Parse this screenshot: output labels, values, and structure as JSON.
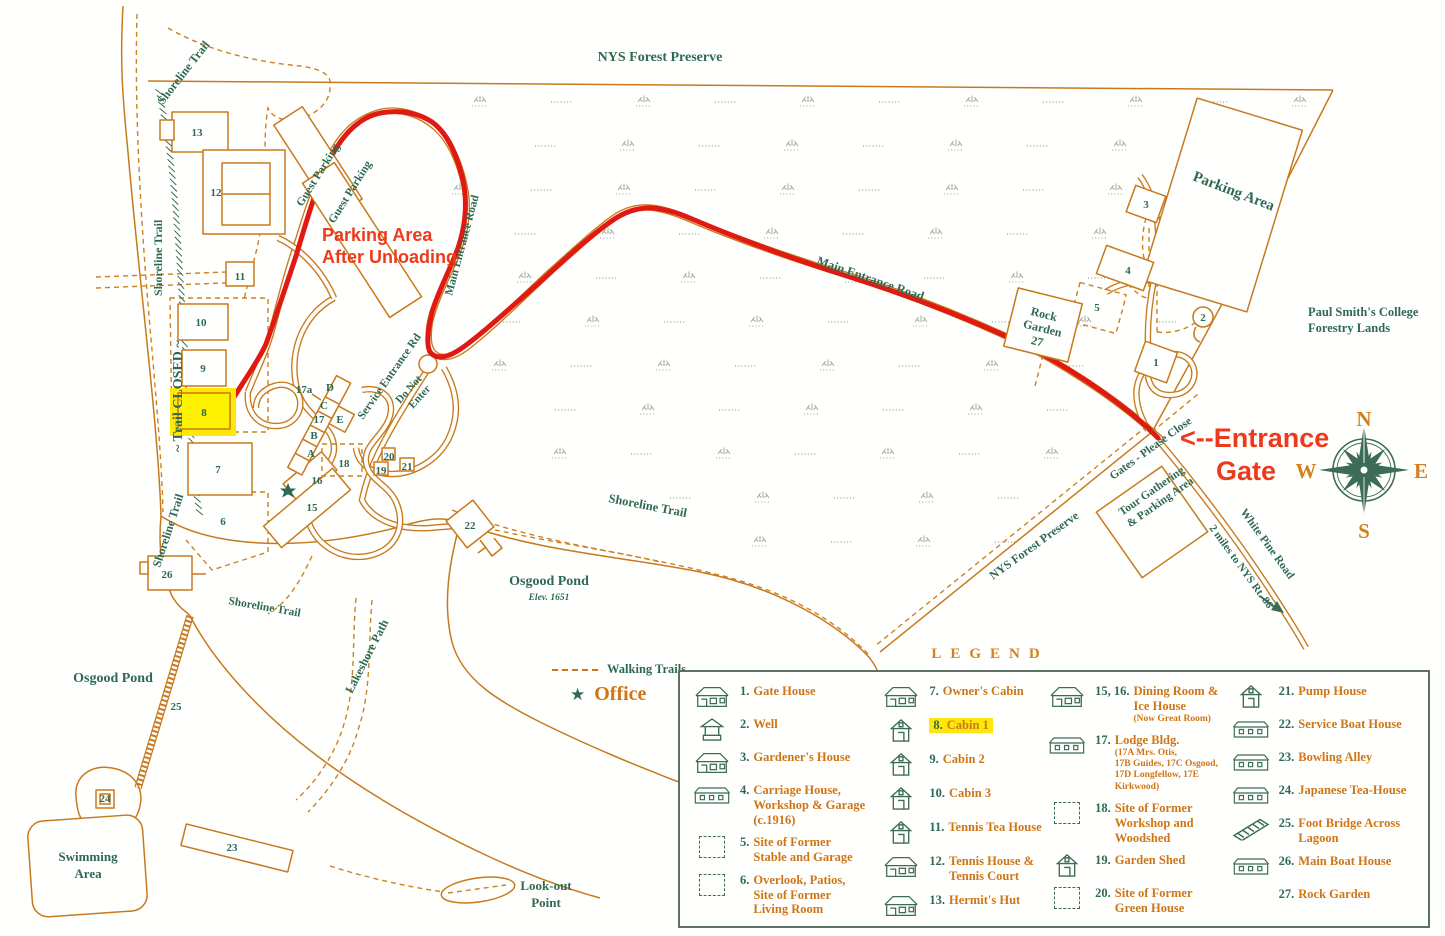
{
  "colors": {
    "map_line_orange": "#c8791b",
    "label_green": "#2f6953",
    "route_red": "#e01a12",
    "annotation_red": "#ee3a1c",
    "highlight_yellow": "#ffe70a"
  },
  "map": {
    "labels": {
      "nys_forest_preserve_top": "NYS Forest Preserve",
      "nys_forest_preserve_diag": "NYS Forest Preserve",
      "shoreline_trail_nw": "Shoreline Trail",
      "shoreline_trail_west": "Shoreline Trail",
      "trail_closed": "~ Trail CLOSED ~",
      "shoreline_trail_sw": "Shoreline Trail",
      "shoreline_trail_mid": "Shoreline Trail",
      "shoreline_trail_low": "Shoreline Trail",
      "guest_parking_1": "Guest Parking",
      "guest_parking_2": "Guest Parking",
      "main_entrance_road_vertical": "Main Entrance Road",
      "main_entrance_road_diagonal": "Main Entrance Road",
      "service_entrance_rd": "Service Entrance Rd",
      "do_not_enter_1": "Do Not",
      "do_not_enter_2": "Enter",
      "parking_area": "Parking Area",
      "rock_garden_1": "Rock",
      "rock_garden_2": "Garden",
      "rock_garden_3": "27",
      "paul_smiths_1": "Paul Smith's College",
      "paul_smiths_2": "Forestry Lands",
      "gates_please_close": "Gates - Please Close",
      "tour_gathering_1": "Tour Gathering",
      "tour_gathering_2": "& Parking Area",
      "white_pine_road": "White Pine Road",
      "miles_to_rt86": "2 miles to NYS Rt. 86",
      "osgood_pond_center": "Osgood Pond",
      "osgood_pond_elev": "Elev. 1651",
      "osgood_pond_west": "Osgood Pond",
      "lakeshore_path": "Lakeshore Path",
      "swimming_area_1": "Swimming",
      "swimming_area_2": "Area",
      "lookout_1": "Look-out",
      "lookout_2": "Point"
    },
    "annotations": {
      "parking_note_1": "Parking Area",
      "parking_note_2": "After Unloading",
      "entrance_gate_1": "<--Entrance",
      "entrance_gate_2": "Gate"
    },
    "compass": {
      "n": "N",
      "e": "E",
      "s": "S",
      "w": "W"
    },
    "numbers": {
      "n1": "1",
      "n2": "2",
      "n3": "3",
      "n4": "4",
      "n5": "5",
      "n6": "6",
      "n7": "7",
      "n8": "8",
      "n9": "9",
      "n10": "10",
      "n11": "11",
      "n12": "12",
      "n13": "13",
      "n15": "15",
      "n16": "16",
      "n17": "17",
      "n17a": "17a",
      "n18": "18",
      "n19": "19",
      "n20": "20",
      "n21": "21",
      "n22": "22",
      "n23": "23",
      "n24": "24",
      "n25": "25",
      "n26": "26"
    },
    "lodge_letters": {
      "a": "A",
      "b": "B",
      "c": "C",
      "d": "D",
      "e": "E"
    }
  },
  "map_key": {
    "walking_trails": "Walking Trails",
    "office": "Office"
  },
  "legend": {
    "title": "LEGEND",
    "items": [
      {
        "num": "1.",
        "label": "Gate House"
      },
      {
        "num": "2.",
        "label": "Well"
      },
      {
        "num": "3.",
        "label": "Gardener's House"
      },
      {
        "num": "4.",
        "label": "Carriage House,\nWorkshop & Garage\n(c.1916)"
      },
      {
        "num": "5.",
        "label": "Site of Former\nStable and Garage"
      },
      {
        "num": "6.",
        "label": "Overlook, Patios,\nSite of Former\nLiving Room"
      },
      {
        "num": "7.",
        "label": "Owner's Cabin"
      },
      {
        "num": "8.",
        "label": "Cabin 1"
      },
      {
        "num": "9.",
        "label": "Cabin 2"
      },
      {
        "num": "10.",
        "label": "Cabin 3"
      },
      {
        "num": "11.",
        "label": "Tennis Tea House"
      },
      {
        "num": "12.",
        "label": "Tennis House &\nTennis Court"
      },
      {
        "num": "13.",
        "label": "Hermit's Hut"
      },
      {
        "num": "15, 16.",
        "label": "Dining Room &\nIce House",
        "sub": "(Now Great Room)"
      },
      {
        "num": "17.",
        "label": "Lodge Bldg.",
        "sub": "(17A Mrs. Otis,\n17B Guides, 17C Osgood,\n17D Longfellow, 17E Kirkwood)"
      },
      {
        "num": "18.",
        "label": "Site of Former\nWorkshop and\nWoodshed"
      },
      {
        "num": "19.",
        "label": "Garden Shed"
      },
      {
        "num": "20.",
        "label": "Site of Former\nGreen House"
      },
      {
        "num": "21.",
        "label": "Pump House"
      },
      {
        "num": "22.",
        "label": "Service Boat House"
      },
      {
        "num": "23.",
        "label": "Bowling Alley"
      },
      {
        "num": "24.",
        "label": "Japanese Tea-House"
      },
      {
        "num": "25.",
        "label": "Foot Bridge Across\nLagoon"
      },
      {
        "num": "26.",
        "label": "Main Boat House"
      },
      {
        "num": "27.",
        "label": "Rock Garden"
      }
    ]
  }
}
